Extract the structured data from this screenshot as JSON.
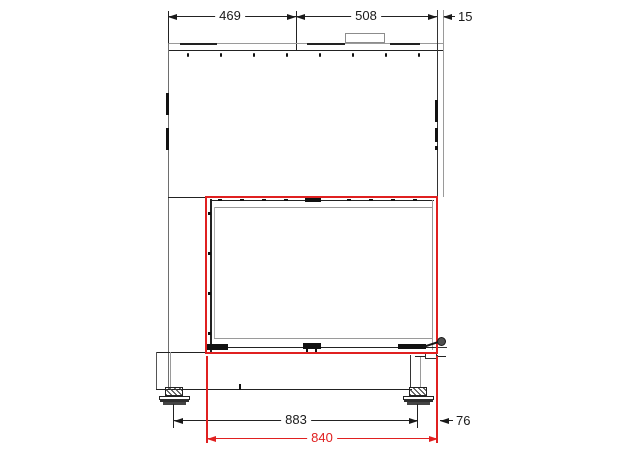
{
  "colors": {
    "highlight_red": "#e02020",
    "line_dark": "#222222",
    "line_light": "#9a9a9a"
  },
  "dims": {
    "top_left_width": "469",
    "top_right_width": "508",
    "right_panel_offset": "15",
    "feet_span": "883",
    "right_foot_offset": "76",
    "glass_opening_width": "840"
  }
}
